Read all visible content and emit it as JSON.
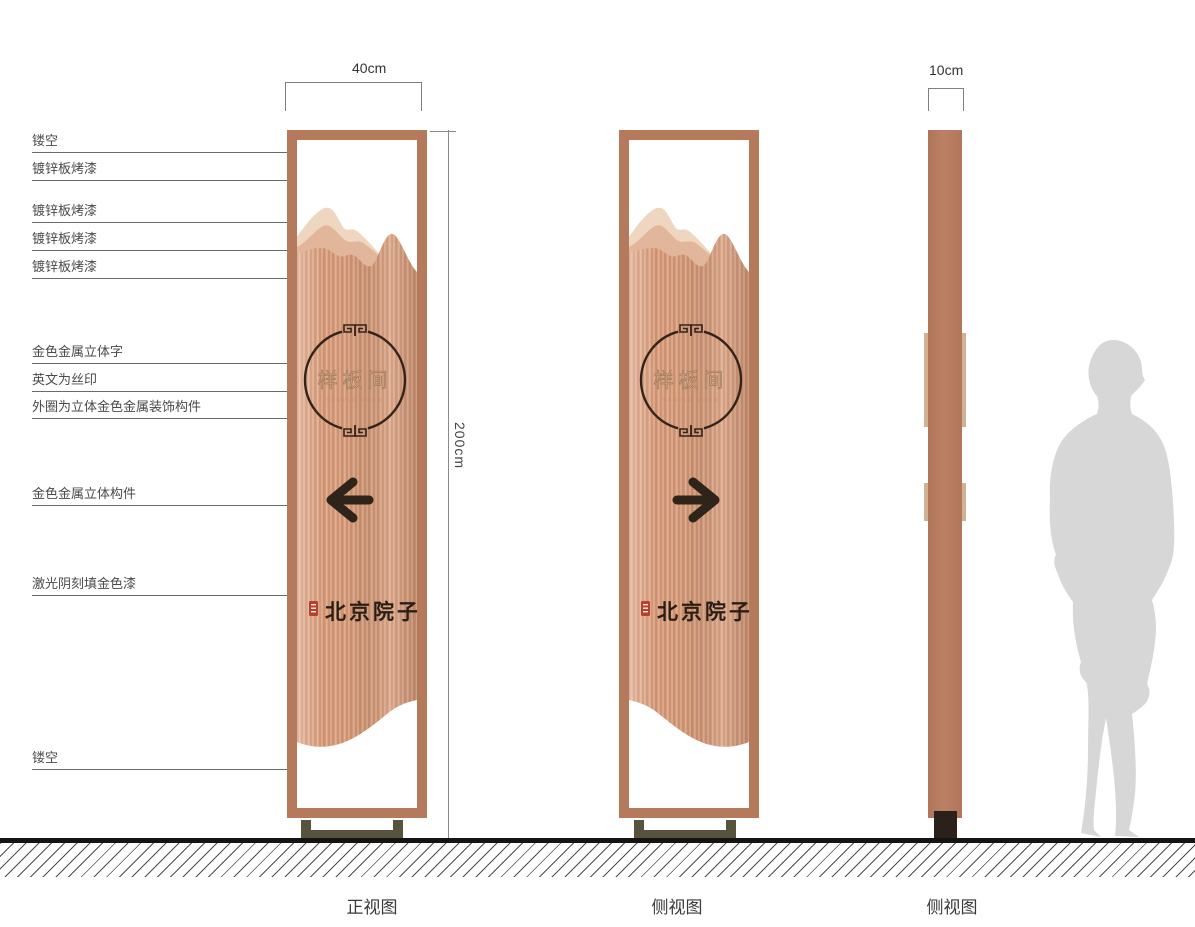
{
  "captions": {
    "front": "正视图",
    "side1": "侧视图",
    "side2": "侧视图"
  },
  "dimensions": {
    "width": "40cm",
    "height": "200cm",
    "depth": "10cm"
  },
  "callouts": [
    "镂空",
    "镀锌板烤漆",
    "镀锌板烤漆",
    "镀锌板烤漆",
    "镀锌板烤漆",
    "金色金属立体字",
    "英文为丝印",
    "外圈为立体金色金属装饰构件",
    "金色金属立体构件",
    "激光阴刻填金色漆",
    "镂空"
  ],
  "sign": {
    "circle_text": "样板间",
    "circle_subtext": "SAMPLE ROOM",
    "logo_text": "北京院子"
  },
  "colors": {
    "frame_copper": "#b5795b",
    "copper_mid": "#d59b7c",
    "copper_light": "#e3b191",
    "mountain_light_1": "#eed6c0",
    "mountain_light_2": "#e2b69a",
    "dark_accent": "#2f2419",
    "seal_red": "#b5402e",
    "base_olive": "#57533e",
    "silhouette_gray": "#d7d7d7"
  }
}
